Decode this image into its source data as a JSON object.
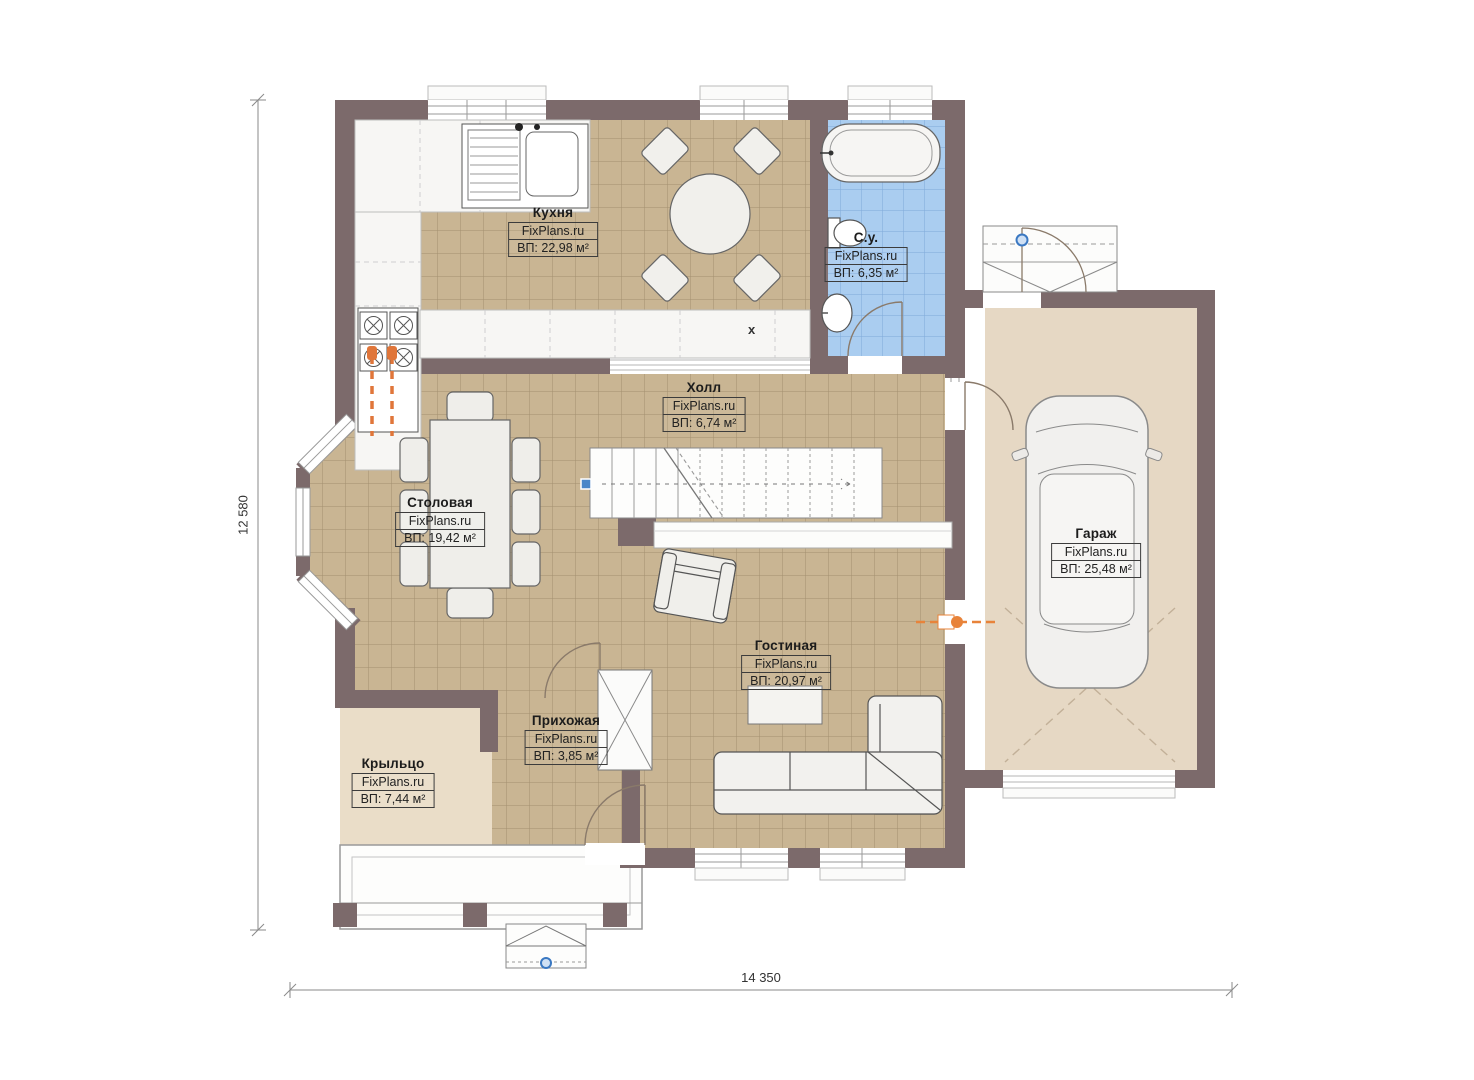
{
  "plan": {
    "rooms": [
      {
        "id": "kitchen",
        "name": "Кухня",
        "watermark": "FixPlans.ru",
        "area": "ВП: 22,98 м²"
      },
      {
        "id": "bathroom",
        "name": "С.у.",
        "watermark": "FixPlans.ru",
        "area": "ВП: 6,35 м²"
      },
      {
        "id": "hall",
        "name": "Холл",
        "watermark": "FixPlans.ru",
        "area": "ВП: 6,74 м²"
      },
      {
        "id": "dining",
        "name": "Столовая",
        "watermark": "FixPlans.ru",
        "area": "ВП: 19,42 м²"
      },
      {
        "id": "garage",
        "name": "Гараж",
        "watermark": "FixPlans.ru",
        "area": "ВП: 25,48 м²"
      },
      {
        "id": "living",
        "name": "Гостиная",
        "watermark": "FixPlans.ru",
        "area": "ВП: 20,97 м²"
      },
      {
        "id": "entry",
        "name": "Прихожая",
        "watermark": "FixPlans.ru",
        "area": "ВП: 3,85 м²"
      },
      {
        "id": "porch",
        "name": "Крыльцо",
        "watermark": "FixPlans.ru",
        "area": "ВП: 7,44 м²"
      }
    ],
    "dimensions": {
      "width_label": "14 350",
      "height_label": "12 580"
    },
    "labels": {
      "counter_mark": "x"
    },
    "colors": {
      "wall": "#7c6a6b",
      "tile_floor": "#c9b593",
      "tile_grid": "#a3906f",
      "bath_floor": "#aacdf0",
      "bath_grid": "#7fa9d9",
      "garage_floor": "#e6d8c4",
      "porch_floor": "#eaddc8",
      "accent_orange": "#e0763a",
      "handle_blue": "#3a78c2"
    }
  }
}
